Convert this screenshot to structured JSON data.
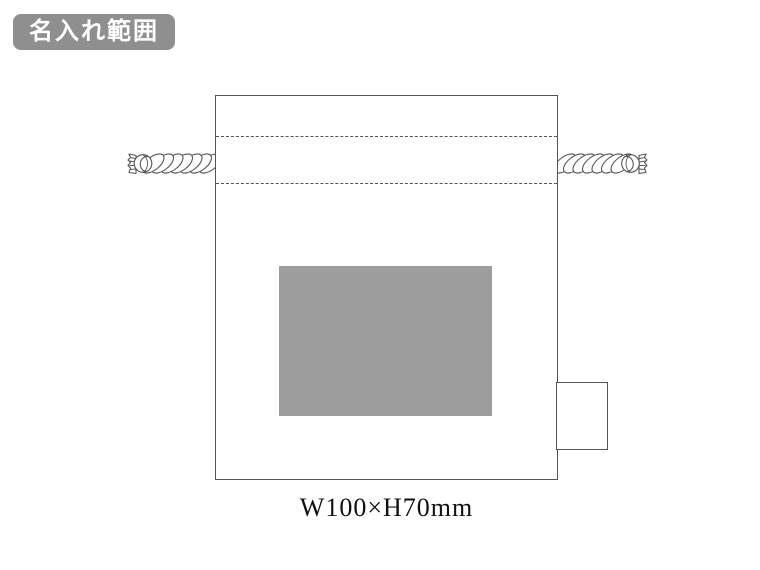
{
  "badge": {
    "label": "名入れ範囲"
  },
  "print_area": {
    "size_label": "W100×H70mm"
  },
  "colors": {
    "background": "#ffffff",
    "badge_bg": "#8f8f8f",
    "badge_text": "#ffffff",
    "outline": "#555555",
    "print_area_fill": "#9d9d9d",
    "size_text": "#111111"
  },
  "icons": {
    "rope_left": "twisted-drawstring-rope",
    "rope_right": "twisted-drawstring-rope"
  }
}
